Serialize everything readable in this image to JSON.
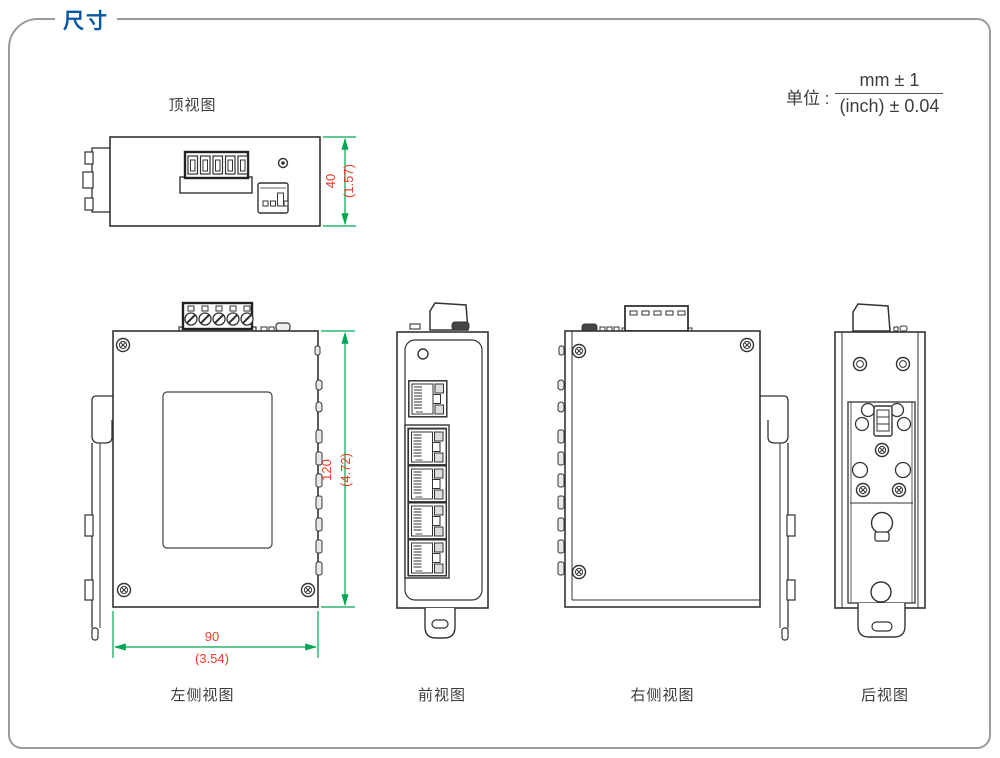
{
  "page": {
    "title": "尺寸"
  },
  "unit": {
    "label": "单位 :",
    "numerator": "mm ± 1",
    "denominator": "(inch) ± 0.04"
  },
  "views": {
    "top": {
      "label": "顶视图",
      "dim_height_mm": "40",
      "dim_height_inch": "(1.57)"
    },
    "left": {
      "label": "左侧视图",
      "dim_height_mm": "120",
      "dim_height_inch": "(4.72)",
      "dim_width_mm": "90",
      "dim_width_inch": "(3.54)"
    },
    "front": {
      "label": "前视图"
    },
    "right": {
      "label": "右侧视图"
    },
    "rear": {
      "label": "后视图"
    }
  },
  "colors": {
    "accent_blue": "#0857a6",
    "dimension_line_green": "#00a651",
    "dimension_text_red": "#ee3b26",
    "frame_border_gray": "#9b9b9b",
    "drawing_line": "#333333"
  }
}
